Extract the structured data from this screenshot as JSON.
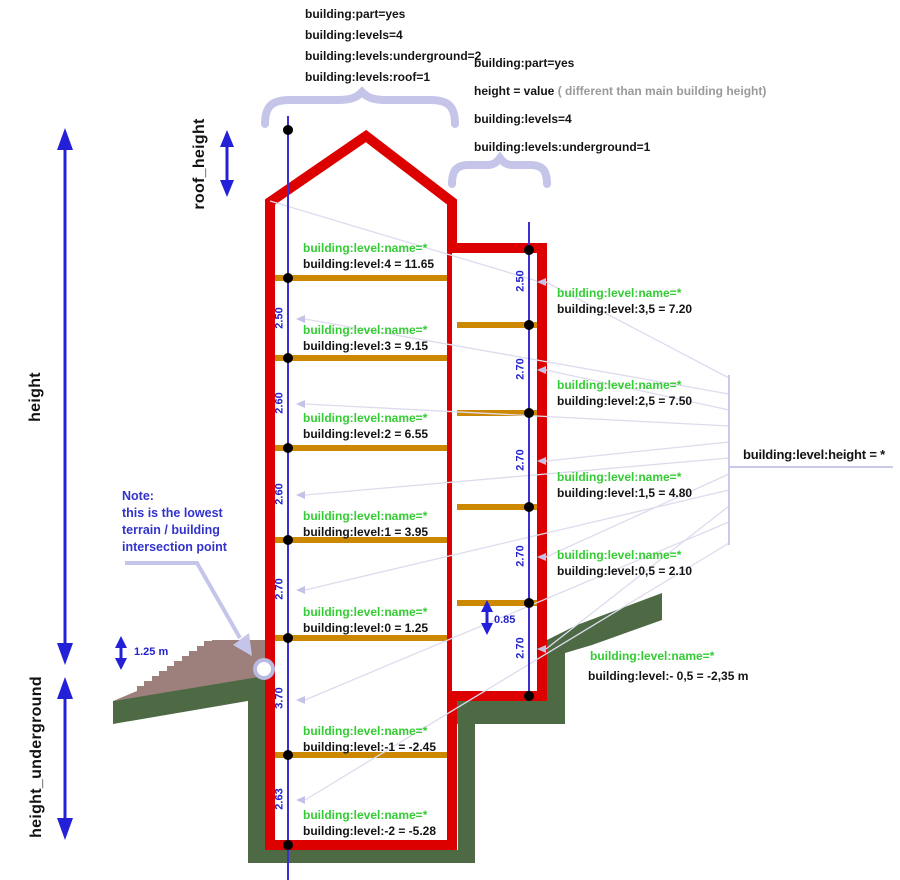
{
  "colors": {
    "building_outline": "#dd0000",
    "floor": "#cc8800",
    "terrain_green": "#4e6a45",
    "stairs_brown": "#9d7f7c",
    "arrow_blue": "#2420d8",
    "axis_blue": "#3b2fd4",
    "tag_green": "#33cc33",
    "lavender": "#c5c5ea",
    "text_black": "#141414",
    "muted_gray": "#9a9a9a",
    "note_blue": "#3333cc"
  },
  "top_left_tags": [
    "building:part=yes",
    "building:levels=4",
    "building:levels:underground=2",
    "building:levels:roof=1"
  ],
  "right_tags": {
    "line1": "building:part=yes",
    "height_bold": "height = value",
    "height_note": " ( different than main building height)",
    "line3": "building:levels=4",
    "line4": "building:levels:underground=1"
  },
  "axis_labels": {
    "roof_height": "roof_height",
    "height": "height",
    "height_underground": "height_underground"
  },
  "note": [
    "Note:",
    "this is the lowest",
    "terrain / building",
    "intersection point"
  ],
  "annotations": {
    "terrain_step": "1.25 m",
    "part_offset": "0.85",
    "level_height": "building:level:height = *"
  },
  "main_building": {
    "floors": [
      {
        "name": "building:level:name=*",
        "value": "building:level:4 = 11.65"
      },
      {
        "name": "building:level:name=*",
        "value": "building:level:3 = 9.15"
      },
      {
        "name": "building:level:name=*",
        "value": "building:level:2 = 6.55"
      },
      {
        "name": "building:level:name=*",
        "value": "building:level:1 = 3.95"
      },
      {
        "name": "building:level:name=*",
        "value": "building:level:0 = 1.25"
      },
      {
        "name": "building:level:name=*",
        "value": "building:level:-1 = -2.45"
      },
      {
        "name": "building:level:name=*",
        "value": "building:level:-2 = -5.28"
      }
    ],
    "dims": [
      "2.50",
      "2.60",
      "2.60",
      "2.70",
      "3.70",
      "2.63"
    ]
  },
  "part_building": {
    "floors": [
      {
        "name": "building:level:name=*",
        "value": "building:level:3,5 = 7.20"
      },
      {
        "name": "building:level:name=*",
        "value": "building:level:2,5 = 7.50"
      },
      {
        "name": "building:level:name=*",
        "value": "building:level:1,5 = 4.80"
      },
      {
        "name": "building:level:name=*",
        "value": "building:level:0,5 = 2.10"
      },
      {
        "name": "building:level:name=*",
        "value": "building:level:- 0,5 = -2,35 m"
      }
    ],
    "dims": [
      "2.50",
      "2.70",
      "2.70",
      "2.70",
      "2.70"
    ]
  }
}
